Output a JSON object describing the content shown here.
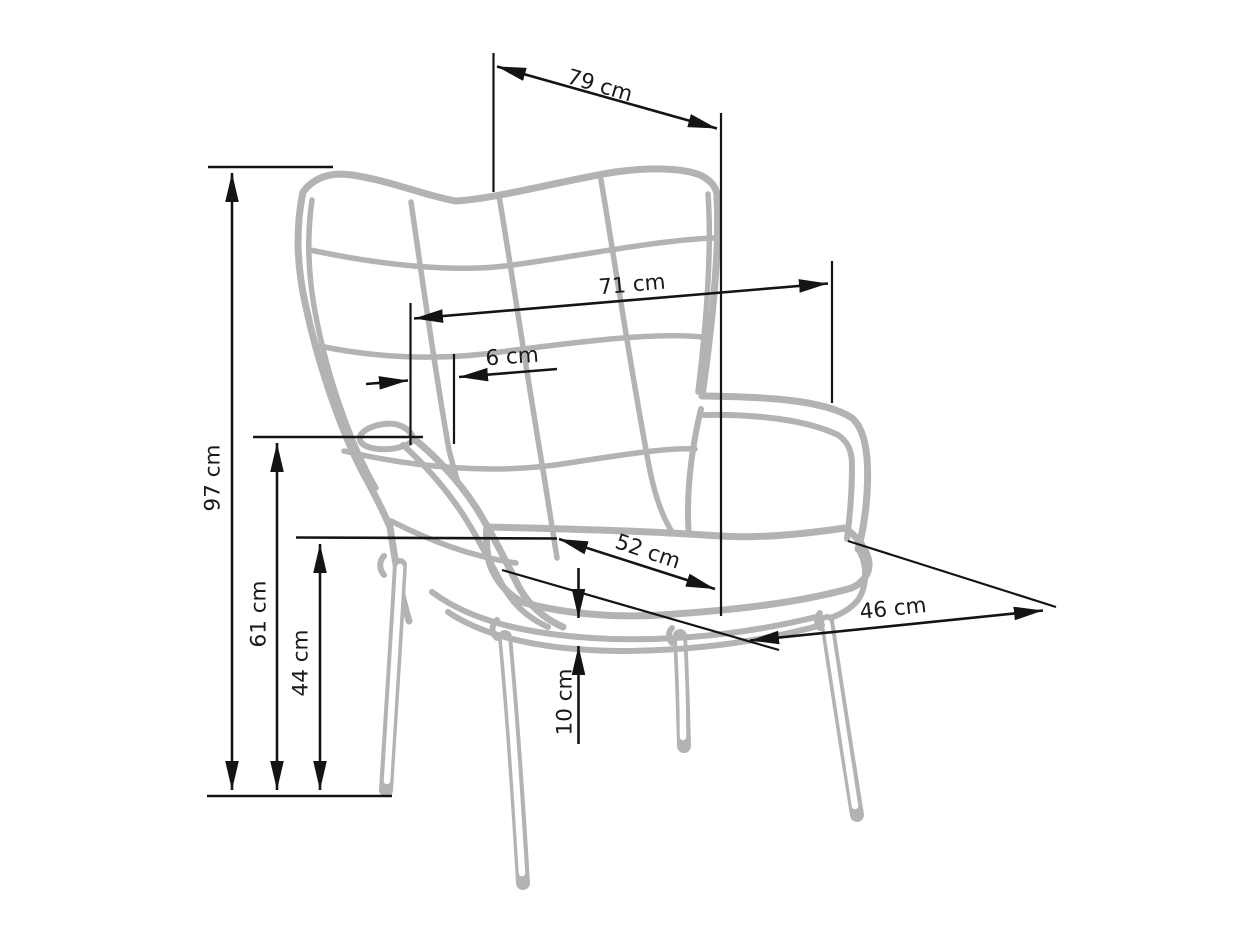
{
  "diagram": {
    "type": "furniture-dimension-drawing",
    "subject": "wingback armchair",
    "units": "cm",
    "colors": {
      "background": "#ffffff",
      "dimension_lines": "#141414",
      "chair_outline": "#b3b3b3"
    },
    "dimensions": {
      "back_top_width": {
        "label": "79 cm",
        "value": 79
      },
      "back_mid_width": {
        "label": "71 cm",
        "value": 71
      },
      "wing_offset": {
        "label": "6 cm",
        "value": 6
      },
      "total_height": {
        "label": "97 cm",
        "value": 97
      },
      "armrest_height": {
        "label": "61 cm",
        "value": 61
      },
      "seat_height": {
        "label": "44 cm",
        "value": 44
      },
      "seat_width": {
        "label": "52 cm",
        "value": 52
      },
      "seat_depth": {
        "label": "46 cm",
        "value": 46
      },
      "base_thickness": {
        "label": "10 cm",
        "value": 10
      }
    }
  }
}
